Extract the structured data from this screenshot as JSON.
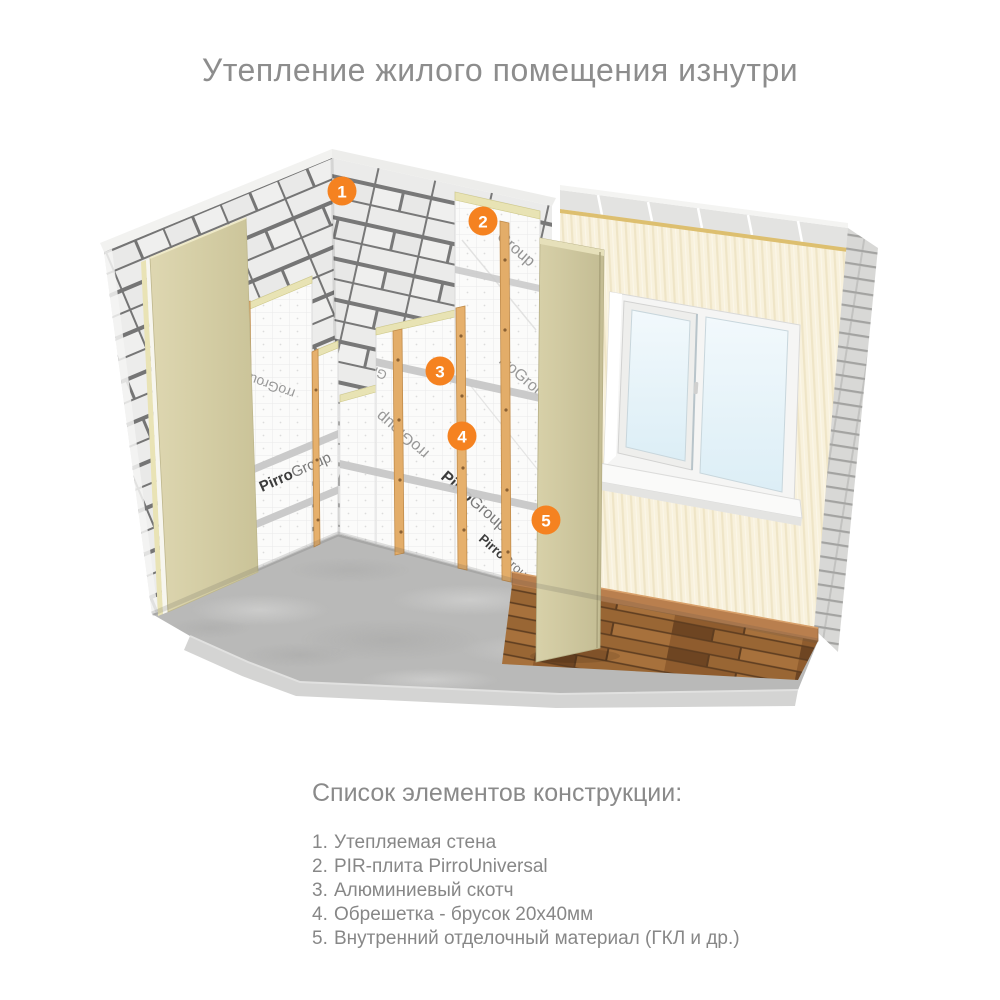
{
  "title": "Утепление жилого помещения изнутри",
  "legend": {
    "heading": "Список элементов конструкции:",
    "items": [
      {
        "num": "1.",
        "label": "Утепляемая стена"
      },
      {
        "num": "2.",
        "label": "PIR-плита PirroUniversal"
      },
      {
        "num": "3.",
        "label": "Алюминиевый скотч"
      },
      {
        "num": "4.",
        "label": "Обрешетка - брусок 20х40мм"
      },
      {
        "num": "5.",
        "label": "Внутренний отделочный материал (ГКЛ и др.)"
      }
    ]
  },
  "markers": [
    {
      "n": "1"
    },
    {
      "n": "2"
    },
    {
      "n": "3"
    },
    {
      "n": "4"
    },
    {
      "n": "5"
    }
  ],
  "brand": {
    "bold": "Pirro",
    "light": "Group",
    "frag": "rroGroup"
  },
  "colors": {
    "accent": "#f58220",
    "title_text": "#8d8d8d",
    "legend_text": "#878787",
    "brick_mortar": "#757575",
    "insulation": "#fbfbfa",
    "pir_core": "#e8e3b4",
    "batten_wood": "#e3ad69",
    "finish_beige": "#d5cea6",
    "wall_cream": "#f8f1dc",
    "floor_concrete": "#b9b9b8",
    "floor_wood": "#8f5c2e"
  }
}
